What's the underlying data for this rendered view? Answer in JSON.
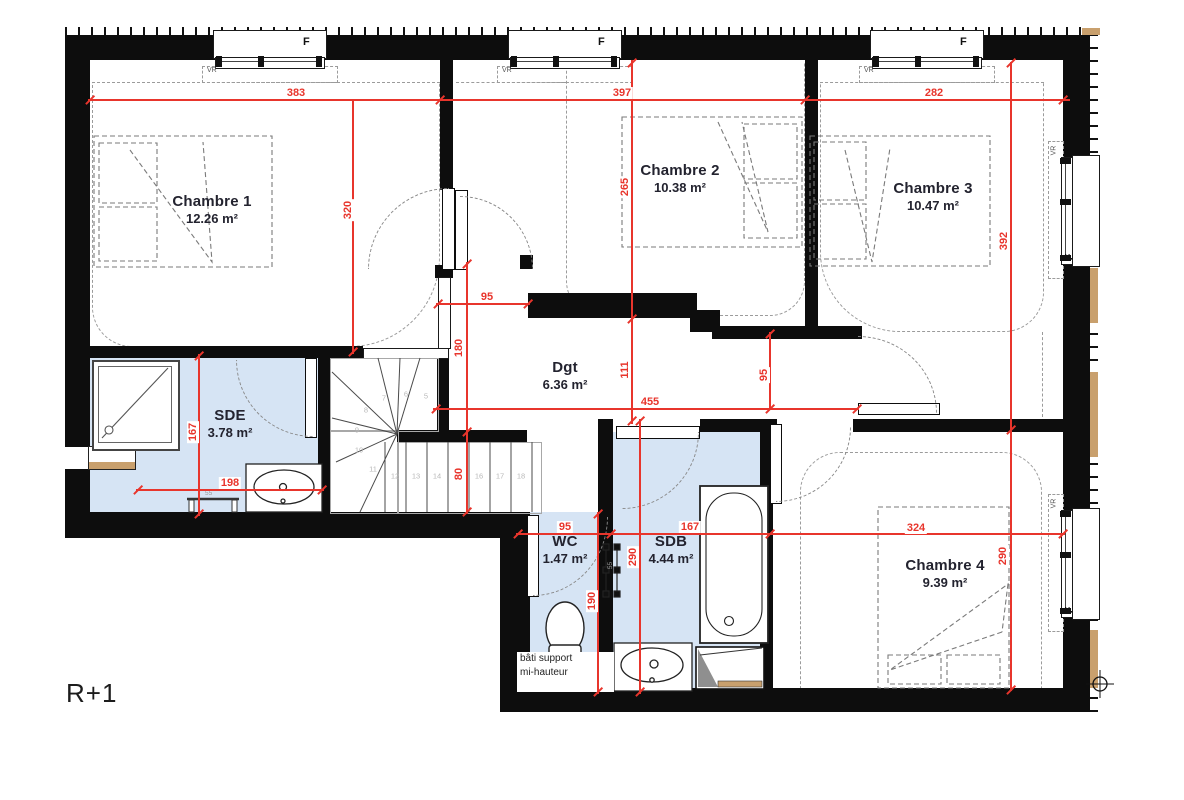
{
  "floor_label": "R+1",
  "colors": {
    "dimension_red": "#e8352c",
    "wet_room_blue": "#d6e4f4",
    "wall_black": "#0d0d0d",
    "wood_tan": "#c9a06d"
  },
  "rooms": [
    {
      "id": "chambre-1",
      "name": "Chambre 1",
      "area": "12.26 m²",
      "cx": 212,
      "cy": 193
    },
    {
      "id": "chambre-2",
      "name": "Chambre 2",
      "area": "10.38 m²",
      "cx": 680,
      "cy": 162
    },
    {
      "id": "chambre-3",
      "name": "Chambre 3",
      "area": "10.47 m²",
      "cx": 933,
      "cy": 180
    },
    {
      "id": "chambre-4",
      "name": "Chambre 4",
      "area": "9.39 m²",
      "cx": 945,
      "cy": 557
    },
    {
      "id": "sde",
      "name": "SDE",
      "area": "3.78 m²",
      "cx": 230,
      "cy": 407
    },
    {
      "id": "dgt",
      "name": "Dgt",
      "area": "6.36 m²",
      "cx": 565,
      "cy": 359
    },
    {
      "id": "wc",
      "name": "WC",
      "area": "1.47 m²",
      "cx": 565,
      "cy": 533
    },
    {
      "id": "sdb",
      "name": "SDB",
      "area": "4.44 m²",
      "cx": 671,
      "cy": 533
    }
  ],
  "dimensions": {
    "lines": [
      [
        88,
        100,
        1070,
        100
      ],
      [
        353,
        100,
        353,
        354
      ],
      [
        632,
        60,
        632,
        424
      ],
      [
        436,
        304,
        530,
        304
      ],
      [
        467,
        262,
        467,
        514
      ],
      [
        433,
        409,
        859,
        409
      ],
      [
        770,
        332,
        770,
        410
      ],
      [
        516,
        534,
        1065,
        534
      ],
      [
        598,
        512,
        598,
        694
      ],
      [
        640,
        419,
        640,
        694
      ],
      [
        1011,
        62,
        1011,
        691
      ],
      [
        199,
        354,
        199,
        516
      ],
      [
        136,
        490,
        324,
        490
      ]
    ],
    "ticks": [
      [
        90,
        100
      ],
      [
        440,
        100
      ],
      [
        805,
        100
      ],
      [
        1063,
        100
      ],
      [
        353,
        352
      ],
      [
        632,
        63
      ],
      [
        632,
        319
      ],
      [
        632,
        421
      ],
      [
        438,
        304
      ],
      [
        528,
        304
      ],
      [
        467,
        264
      ],
      [
        467,
        432
      ],
      [
        467,
        512
      ],
      [
        436,
        409
      ],
      [
        857,
        409
      ],
      [
        770,
        334
      ],
      [
        770,
        409
      ],
      [
        518,
        534
      ],
      [
        611,
        534
      ],
      [
        770,
        534
      ],
      [
        1063,
        534
      ],
      [
        598,
        514
      ],
      [
        598,
        692
      ],
      [
        640,
        421
      ],
      [
        640,
        692
      ],
      [
        1011,
        63
      ],
      [
        1011,
        430
      ],
      [
        1011,
        690
      ],
      [
        199,
        356
      ],
      [
        199,
        514
      ],
      [
        138,
        490
      ],
      [
        322,
        490
      ]
    ],
    "labels": [
      {
        "t": "383",
        "x": 296,
        "y": 93,
        "r": 0
      },
      {
        "t": "397",
        "x": 622,
        "y": 93,
        "r": 0
      },
      {
        "t": "282",
        "x": 934,
        "y": 93,
        "r": 0
      },
      {
        "t": "320",
        "x": 348,
        "y": 210,
        "r": 1
      },
      {
        "t": "265",
        "x": 625,
        "y": 187,
        "r": 1
      },
      {
        "t": "111",
        "x": 625,
        "y": 370,
        "r": 1
      },
      {
        "t": "95",
        "x": 487,
        "y": 297,
        "r": 0
      },
      {
        "t": "180",
        "x": 459,
        "y": 348,
        "r": 1
      },
      {
        "t": "80",
        "x": 459,
        "y": 474,
        "r": 1
      },
      {
        "t": "455",
        "x": 650,
        "y": 402,
        "r": 0
      },
      {
        "t": "95",
        "x": 764,
        "y": 375,
        "r": 1
      },
      {
        "t": "392",
        "x": 1004,
        "y": 241,
        "r": 1
      },
      {
        "t": "290",
        "x": 1003,
        "y": 556,
        "r": 1
      },
      {
        "t": "167",
        "x": 193,
        "y": 432,
        "r": 1
      },
      {
        "t": "198",
        "x": 230,
        "y": 483,
        "r": 0
      },
      {
        "t": "95",
        "x": 565,
        "y": 527,
        "r": 0
      },
      {
        "t": "167",
        "x": 690,
        "y": 527,
        "r": 0
      },
      {
        "t": "324",
        "x": 916,
        "y": 528,
        "r": 0
      },
      {
        "t": "190",
        "x": 592,
        "y": 601,
        "r": 1
      },
      {
        "t": "290",
        "x": 633,
        "y": 557,
        "r": 1
      }
    ]
  },
  "windows": {
    "f_label": "F",
    "vr_label": "VR",
    "top_x": [
      213,
      508,
      870
    ],
    "right_y": [
      155,
      508
    ]
  },
  "stairs": {
    "numbers": [
      {
        "t": "5",
        "x": 426,
        "y": 396
      },
      {
        "t": "6",
        "x": 406,
        "y": 394
      },
      {
        "t": "7",
        "x": 384,
        "y": 398
      },
      {
        "t": "8",
        "x": 366,
        "y": 410
      },
      {
        "t": "9",
        "x": 357,
        "y": 430
      },
      {
        "t": "10",
        "x": 359,
        "y": 450
      },
      {
        "t": "11",
        "x": 373,
        "y": 469
      },
      {
        "t": "12",
        "x": 395,
        "y": 476
      },
      {
        "t": "13",
        "x": 416,
        "y": 476
      },
      {
        "t": "14",
        "x": 437,
        "y": 476
      },
      {
        "t": "16",
        "x": 479,
        "y": 476
      },
      {
        "t": "17",
        "x": 500,
        "y": 476
      },
      {
        "t": "18",
        "x": 521,
        "y": 476
      }
    ]
  },
  "notes": {
    "bati_line1": "bâti support",
    "bati_line2": "mi-hauteur",
    "rad_sde": "55",
    "rad_sdb": "55"
  }
}
